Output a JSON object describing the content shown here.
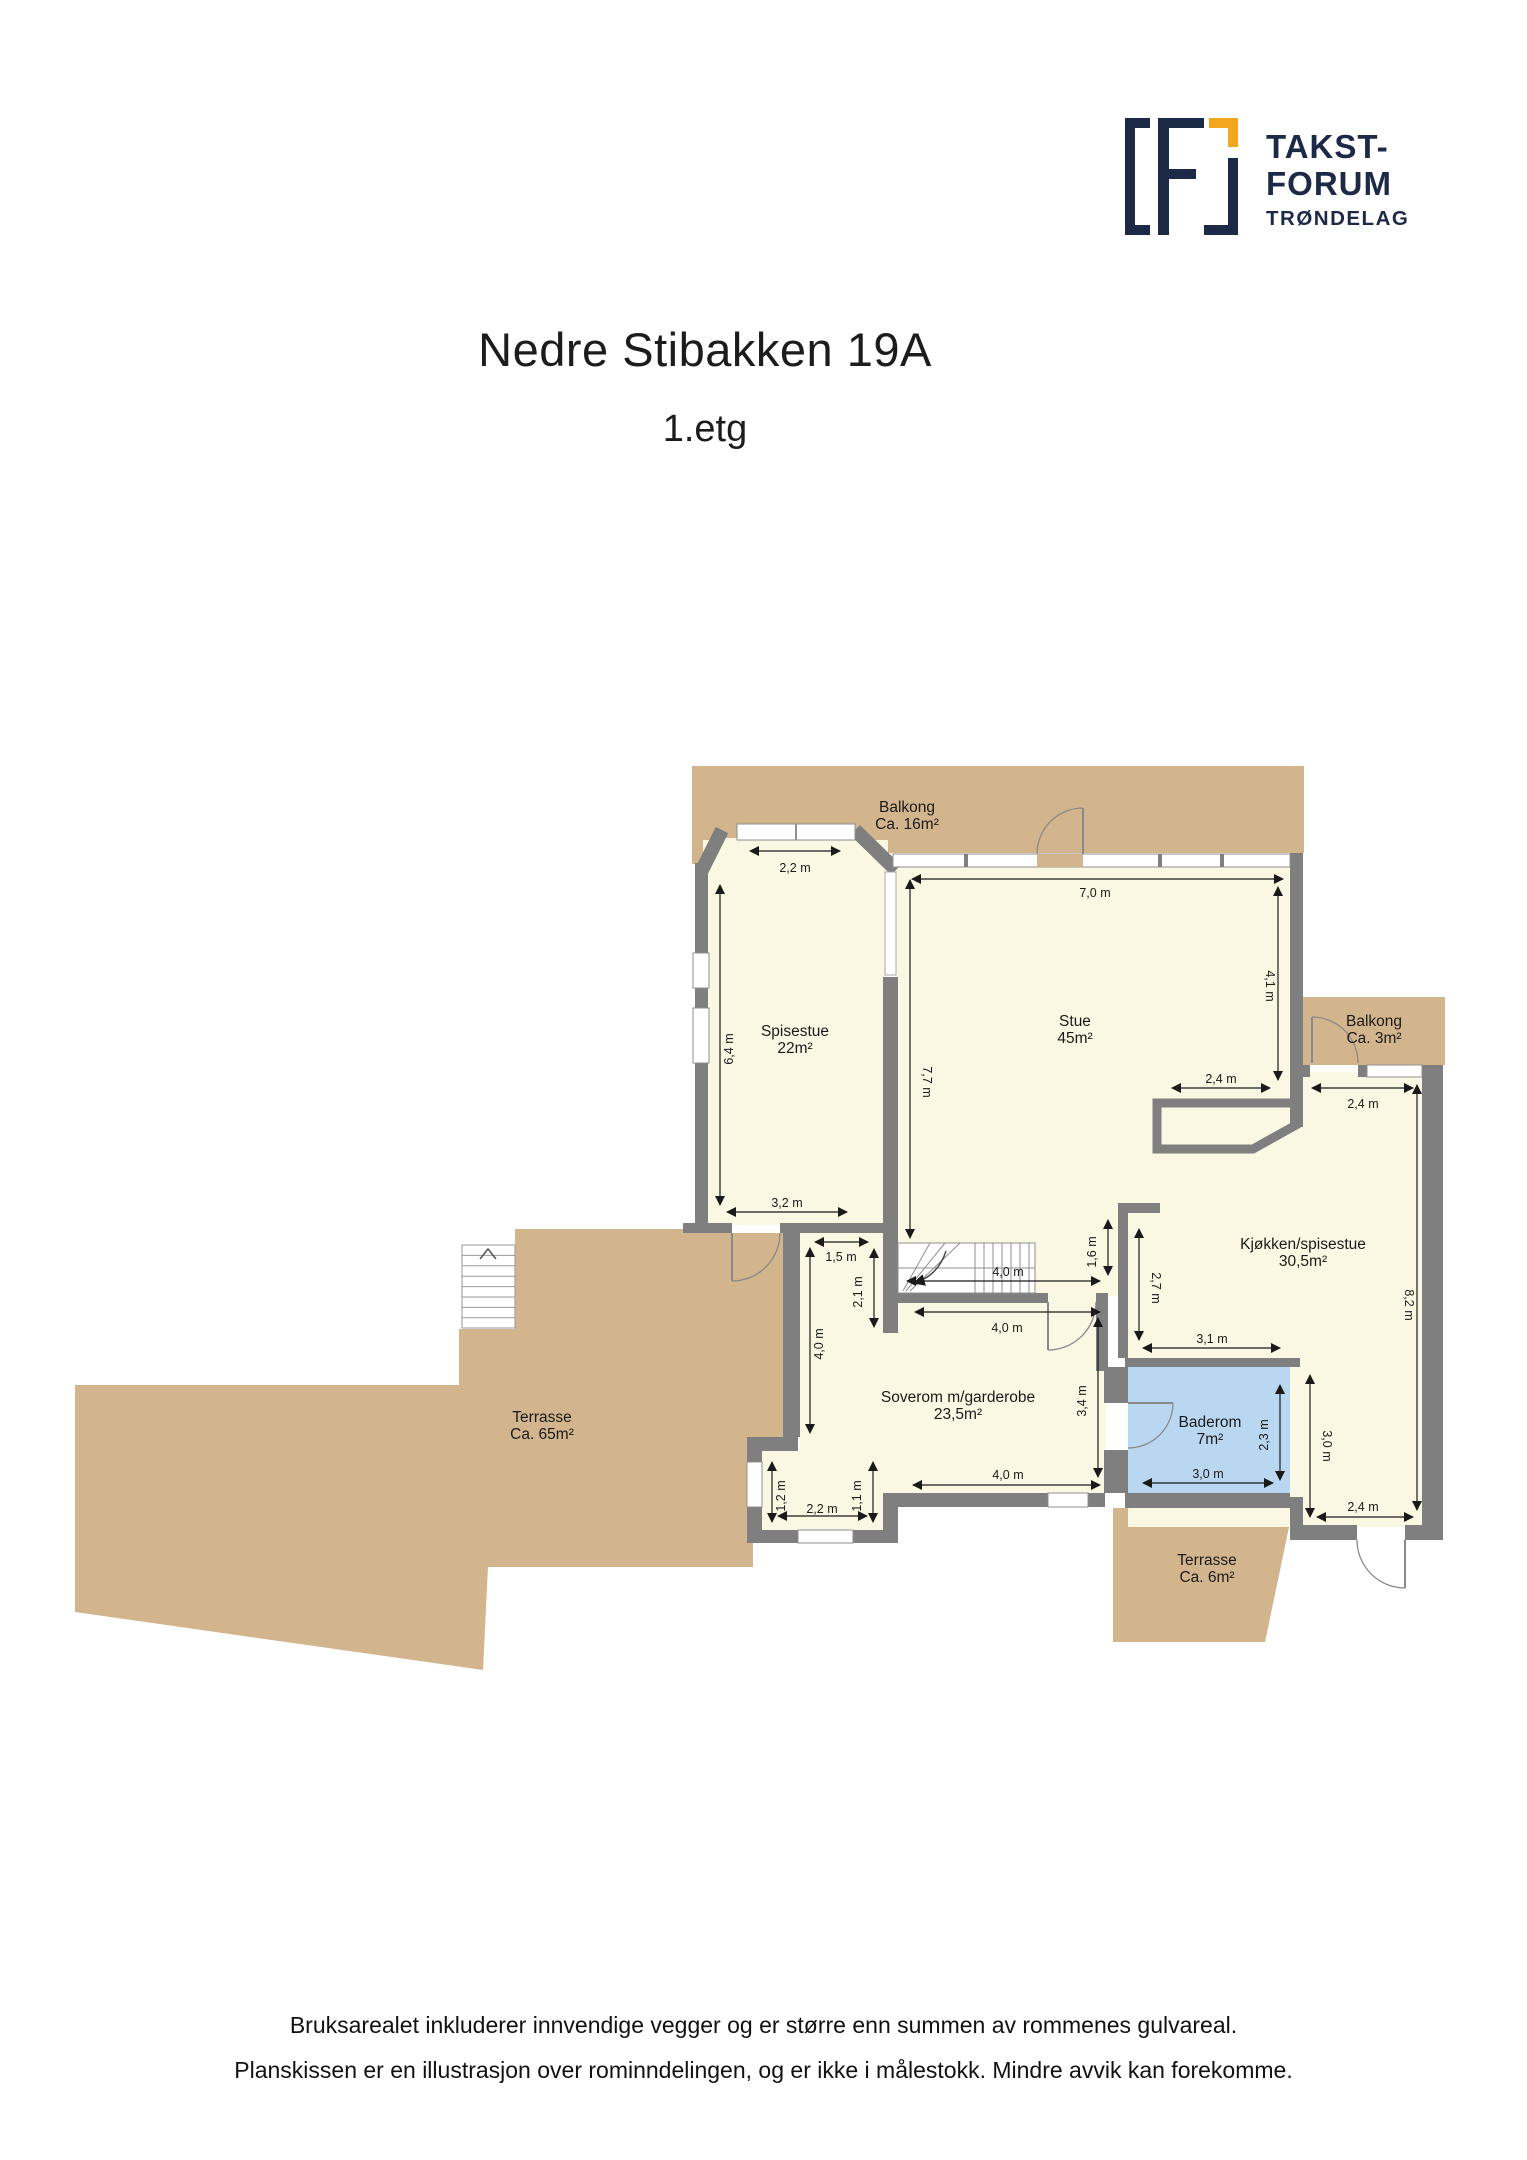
{
  "header": {
    "title": "Nedre Stibakken 19A",
    "subtitle": "1.etg"
  },
  "logo": {
    "line1": "TAKST-",
    "line2": "FORUM",
    "line3": "TRØNDELAG"
  },
  "rooms": [
    {
      "name": "Balkong",
      "area": "Ca. 16m²"
    },
    {
      "name": "Spisestue",
      "area": "22m²"
    },
    {
      "name": "Stue",
      "area": "45m²"
    },
    {
      "name": "Balkong",
      "area": "Ca. 3m²"
    },
    {
      "name": "Kjøkken/spisestue",
      "area": "30,5m²"
    },
    {
      "name": "Soverom m/garderobe",
      "area": "23,5m²"
    },
    {
      "name": "Baderom",
      "area": "7m²"
    },
    {
      "name": "Terrasse",
      "area": "Ca. 65m²"
    },
    {
      "name": "Terrasse",
      "area": "Ca. 6m²"
    }
  ],
  "dimensions": [
    "2,2 m",
    "7,0 m",
    "6,4 m",
    "7,7 m",
    "4,1 m",
    "2,4 m",
    "2,4 m",
    "3,2 m",
    "4,0 m",
    "4,0 m",
    "1,6 m",
    "2,7 m",
    "2,1 m",
    "1,5 m",
    "4,0 m",
    "3,4 m",
    "4,0 m",
    "1,2 m",
    "1,1 m",
    "2,2 m",
    "2,3 m",
    "3,0 m",
    "3,1 m",
    "8,2 m",
    "3,0 m",
    "2,4 m"
  ],
  "footer": {
    "line1": "Bruksarealet inkluderer innvendige vegger og er større enn summen av rommenes gulvareal.",
    "line2": "Planskissen er en illustrasjon over rominndelingen, og er ikke i målestokk. Mindre avvik kan forekomme."
  },
  "colors": {
    "wall": "#7f7f7f",
    "room": "#FAF8E3",
    "outdoor": "#D2B58D",
    "bathroom": "#BAD7F1",
    "logo_navy": "#1d2a47",
    "logo_gold": "#F2A71F",
    "dim_line": "#1a1a1a",
    "window_frame": "#8f8f8f"
  }
}
